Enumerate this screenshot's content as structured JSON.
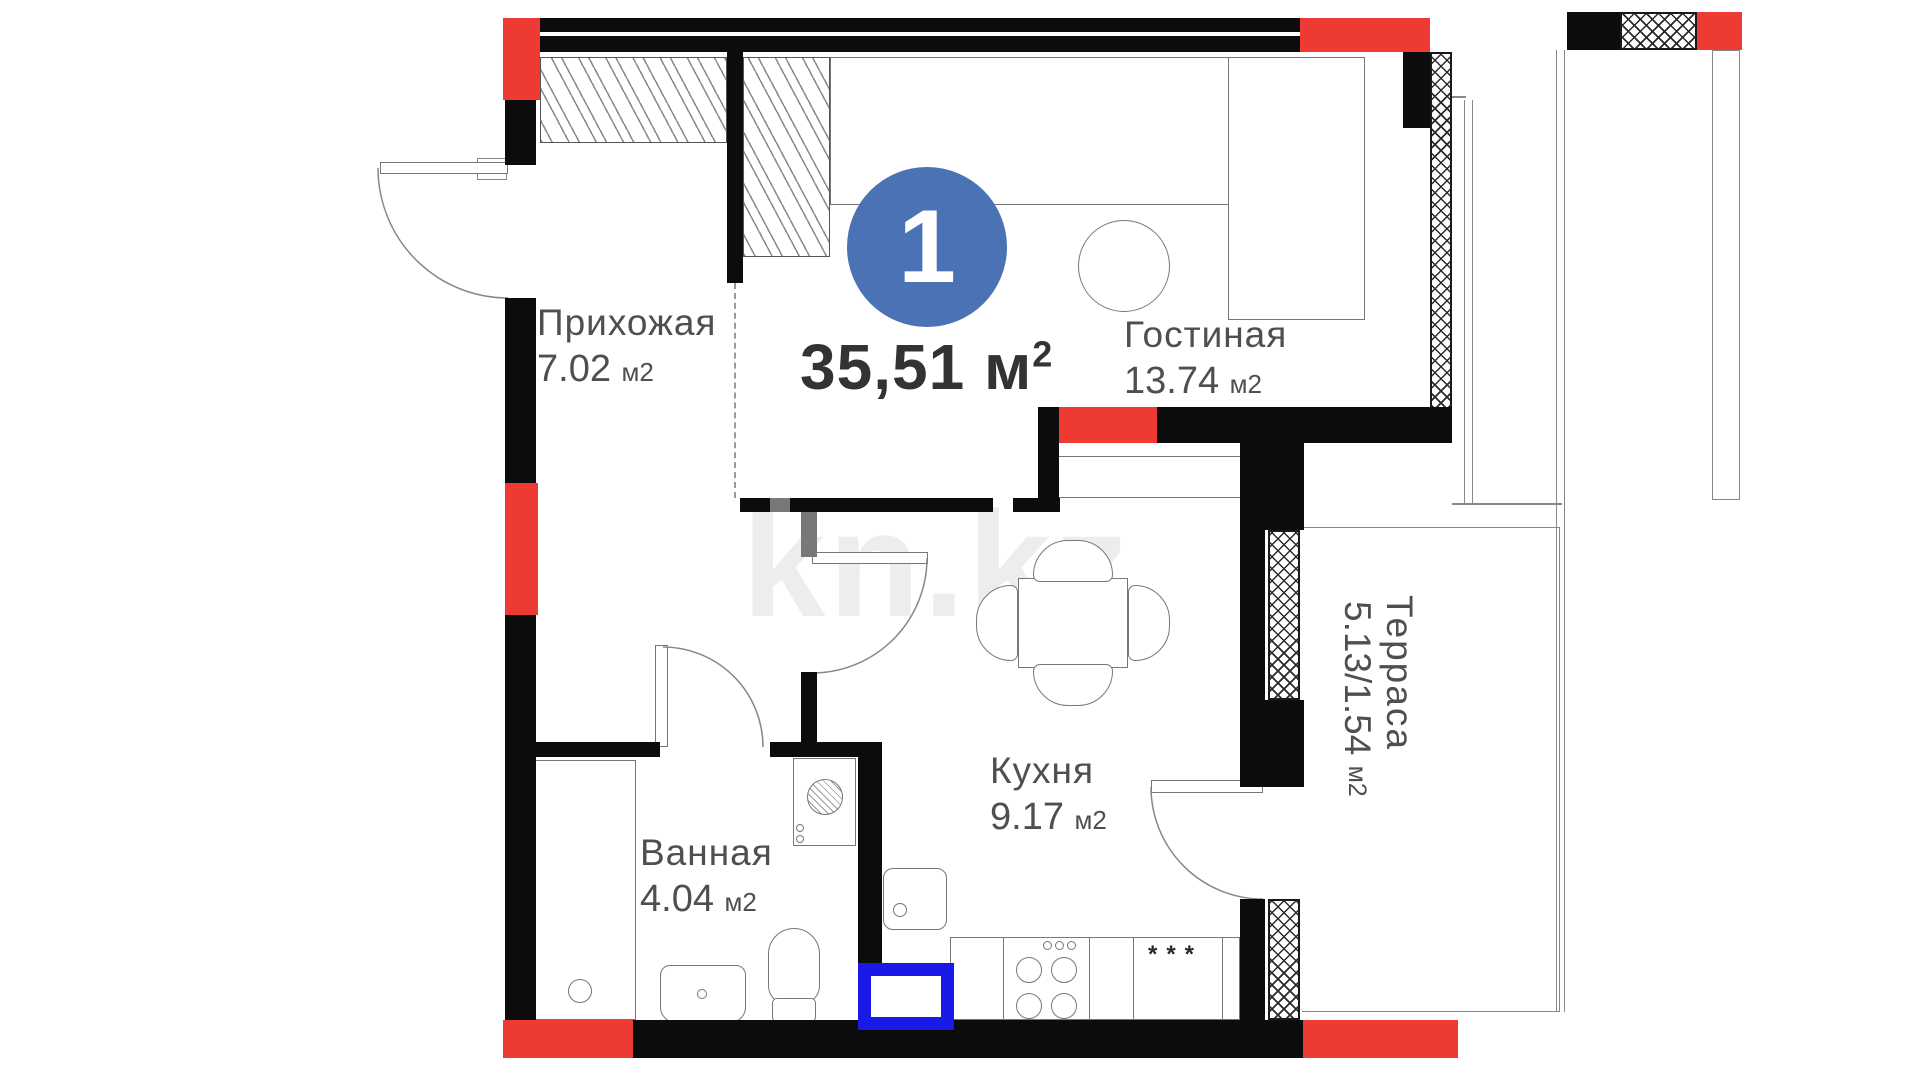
{
  "plan": {
    "badge": {
      "number": "1"
    },
    "total_area": {
      "value": "35,51",
      "unit": "м",
      "exponent": "2"
    },
    "rooms": [
      {
        "name": "Прихожая",
        "area": "7.02",
        "unit": "м2"
      },
      {
        "name": "Гостиная",
        "area": "13.74",
        "unit": "м2"
      },
      {
        "name": "Кухня",
        "area": "9.17",
        "unit": "м2"
      },
      {
        "name": "Ванная",
        "area": "4.04",
        "unit": "м2"
      },
      {
        "name": "Терраса",
        "area": "5.13/1.54",
        "unit": "м2"
      }
    ],
    "watermark": "kn.kz",
    "fridge_symbol": "***",
    "colors": {
      "wall": "#0c0c0c",
      "load_bearing_red": "#ee3a34",
      "badge_blue": "#4a72b4",
      "sink_highlight_blue": "#1a1ae8",
      "furniture_line": "#777777",
      "label_gray": "#4f4f4f",
      "watermark_gray": "#ededed"
    }
  }
}
